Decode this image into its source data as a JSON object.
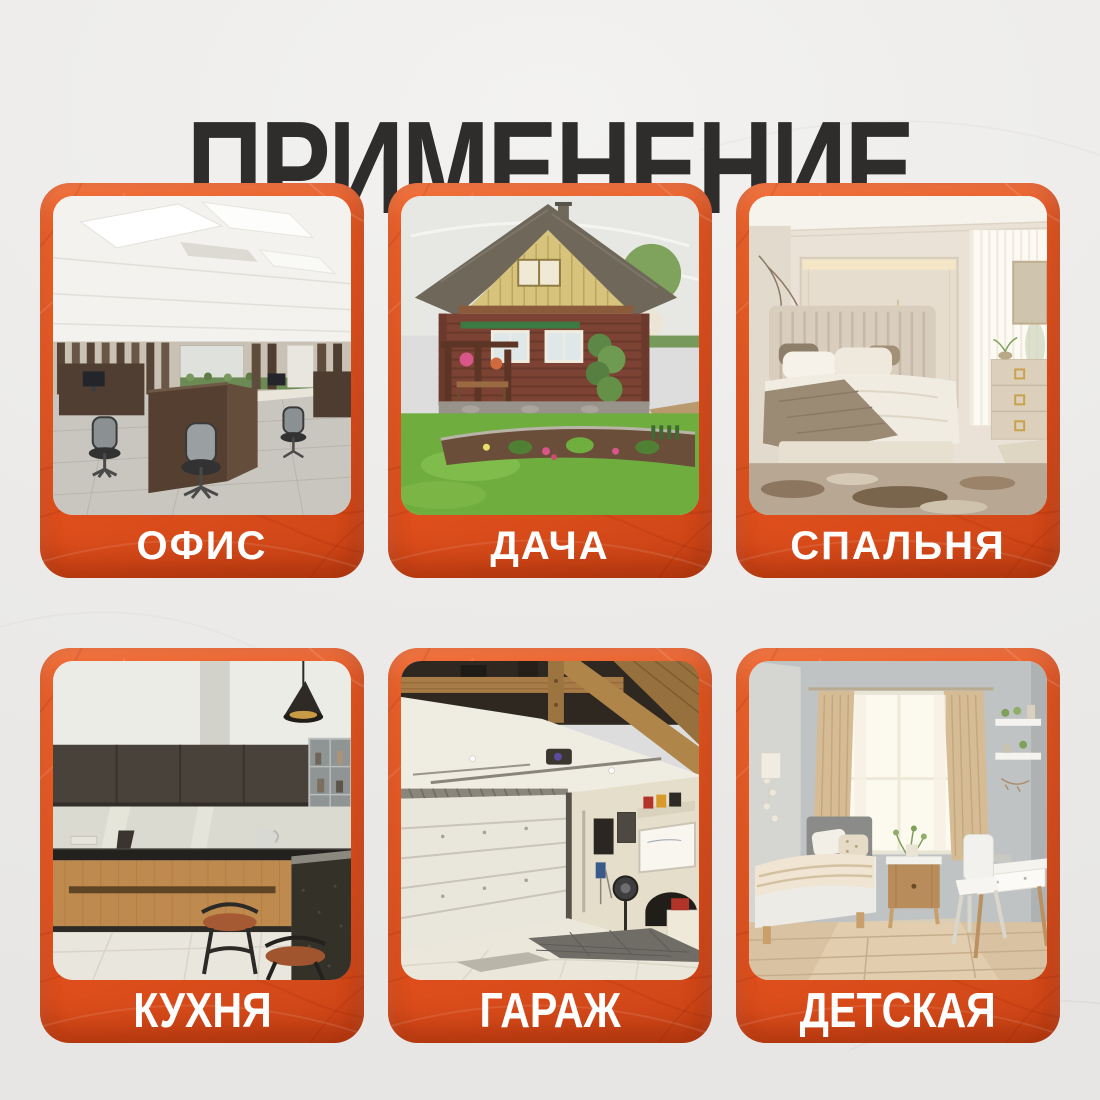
{
  "title": "ПРИМЕНЕНИЕ",
  "colors": {
    "background": "#ebeae8",
    "card_orange": "#e8571f",
    "card_orange_light": "#f2652a",
    "card_orange_dark": "#cc4517",
    "title_text": "#2e2d2b",
    "label_text": "#ffffff"
  },
  "cards": [
    {
      "label": "ОФИС",
      "scene": "office-interior-photo"
    },
    {
      "label": "ДАЧА",
      "scene": "country-house-photo"
    },
    {
      "label": "СПАЛЬНЯ",
      "scene": "bedroom-photo"
    },
    {
      "label": "КУХНЯ",
      "scene": "kitchen-photo"
    },
    {
      "label": "ГАРАЖ",
      "scene": "garage-photo"
    },
    {
      "label": "ДЕТСКАЯ",
      "scene": "children-room-photo"
    }
  ]
}
